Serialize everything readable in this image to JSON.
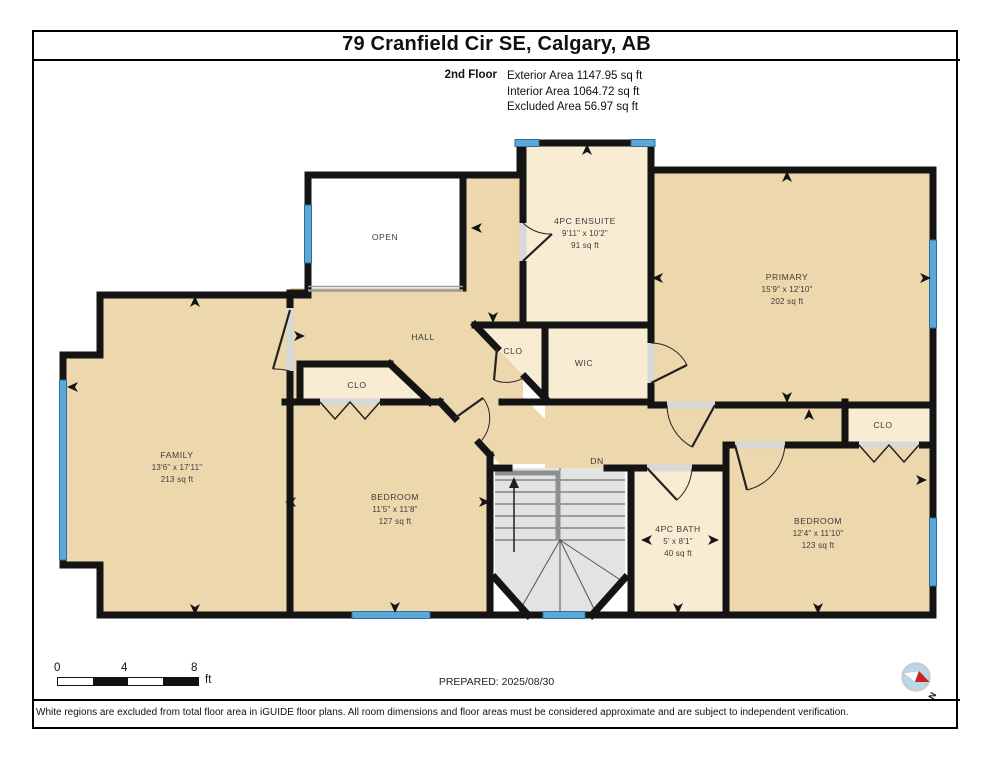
{
  "page": {
    "title": "79 Cranfield Cir SE, Calgary, AB",
    "floor_label": "2nd Floor",
    "exterior_area": "Exterior Area 1147.95 sq ft",
    "interior_area": "Interior Area 1064.72 sq ft",
    "excluded_area": "Excluded Area 56.97 sq ft"
  },
  "rooms": {
    "open": {
      "name": "OPEN"
    },
    "hall": {
      "name": "HALL"
    },
    "dn": {
      "name": "DN"
    },
    "wic": {
      "name": "WIC"
    },
    "clo_hall": {
      "name": "CLO"
    },
    "clo_bedroom": {
      "name": "CLO"
    },
    "clo_bedroom2": {
      "name": "CLO"
    },
    "family": {
      "name": "FAMILY",
      "dims": "13'6\" x 17'11\"",
      "area": "213 sq ft"
    },
    "ensuite": {
      "name": "4PC ENSUITE",
      "dims": "9'11\" x 10'2\"",
      "area": "91 sq ft"
    },
    "primary": {
      "name": "PRIMARY",
      "dims": "15'9\" x 12'10\"",
      "area": "202 sq ft"
    },
    "bedroom1": {
      "name": "BEDROOM",
      "dims": "11'5\" x 11'8\"",
      "area": "127 sq ft"
    },
    "bedroom2": {
      "name": "BEDROOM",
      "dims": "12'4\" x 11'10\"",
      "area": "123 sq ft"
    },
    "bath": {
      "name": "4PC BATH",
      "dims": "5' x 8'1\"",
      "area": "40 sq ft"
    }
  },
  "footer": {
    "scale_ticks": [
      "0",
      "4",
      "8"
    ],
    "scale_unit": "ft",
    "prepared": "PREPARED: 2025/08/30",
    "compass_label": "N",
    "disclaimer": "White regions are excluded from total floor area in iGUIDE floor plans. All room dimensions and floor areas must be considered approximate and are subject to independent verification."
  },
  "icons": {
    "compass": "compass-north-icon",
    "dimension_arrow": "dimension-arrow-icon",
    "stairs_up_arrow": "stairs-direction-arrow-icon"
  },
  "colors": {
    "wall": "#141414",
    "room": "#ecd8ac",
    "room_light": "#f8edd3",
    "open_region": "#ffffff",
    "window_blue": "#5ca8d8",
    "stairs_gray": "#e3e3e3",
    "compass_red": "#cc2222"
  }
}
